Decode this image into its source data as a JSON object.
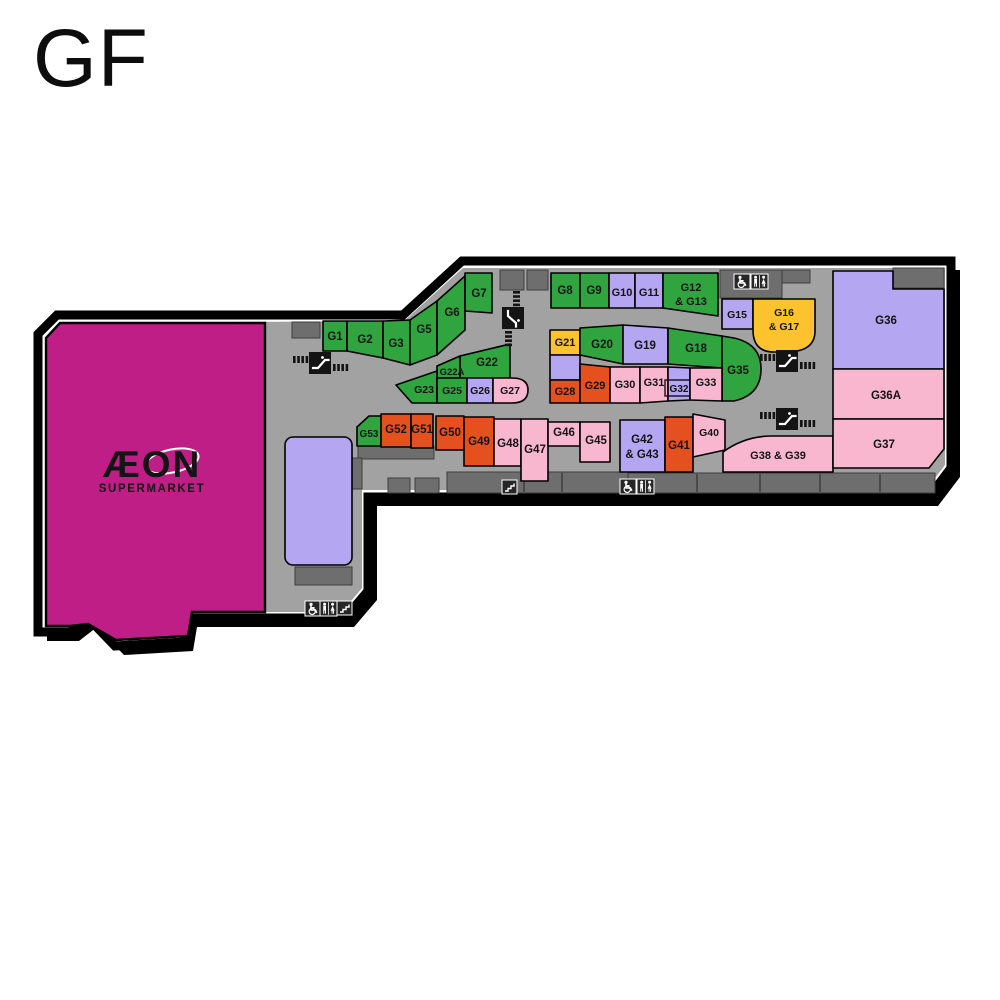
{
  "title": "GF",
  "supermarket": {
    "name": "ÆON",
    "subtitle": "SUPERMARKET"
  },
  "palette": {
    "green": "#2FA43F",
    "lavender": "#B4A6F0",
    "yellow": "#FDC32F",
    "orange": "#E4511E",
    "pink": "#F9B6CF",
    "magenta": "#BE1E86",
    "walkway": "#A2A2A2",
    "service": "#6E6E6E",
    "iconBox": "#262626",
    "outline": "#000000"
  },
  "outline": {
    "outer": "M38,334 L57,315 L403,315 L462,261 L951,261 L951,468 L929,497 L368,497 L368,591 L345,618 L188,618 L184,642 L115,646 L88,618 L70,632 L38,632 Z",
    "inner": "M46,338 L60,323 L404,321 L463,268 L945,268 L945,465 L926,490 L362,490 L362,588 L342,612 L192,612 L188,636 L116,640 L88,624 L71,626 L46,626 Z",
    "aeon": "M60,323 L265,323 L265,612 L192,612 L188,636 L116,640 L88,624 L71,626 L46,626 L46,338 Z"
  },
  "units": [
    {
      "id": "G1",
      "label": "G1",
      "color": "green",
      "poly": [
        [
          323,
          321
        ],
        [
          347,
          321
        ],
        [
          347,
          351
        ],
        [
          323,
          351
        ]
      ],
      "lx": 335,
      "ly": 340
    },
    {
      "id": "G2",
      "label": "G2",
      "color": "green",
      "poly": [
        [
          347,
          321
        ],
        [
          383,
          321
        ],
        [
          383,
          358
        ],
        [
          347,
          351
        ]
      ],
      "lx": 365,
      "ly": 343
    },
    {
      "id": "G3",
      "label": "G3",
      "color": "green",
      "poly": [
        [
          383,
          321
        ],
        [
          410,
          320
        ],
        [
          410,
          365
        ],
        [
          383,
          358
        ]
      ],
      "lx": 396,
      "ly": 347
    },
    {
      "id": "G5",
      "label": "G5",
      "color": "green",
      "poly": [
        [
          410,
          320
        ],
        [
          437,
          301
        ],
        [
          437,
          355
        ],
        [
          410,
          365
        ]
      ],
      "lx": 424,
      "ly": 333
    },
    {
      "id": "G6",
      "label": "G6",
      "color": "green",
      "poly": [
        [
          437,
          301
        ],
        [
          465,
          276
        ],
        [
          465,
          330
        ],
        [
          437,
          355
        ]
      ],
      "lx": 452,
      "ly": 316
    },
    {
      "id": "G7",
      "label": "G7",
      "color": "green",
      "poly": [
        [
          465,
          273
        ],
        [
          492,
          273
        ],
        [
          492,
          313
        ],
        [
          465,
          311
        ]
      ],
      "lx": 479,
      "ly": 297
    },
    {
      "id": "G8",
      "label": "G8",
      "color": "green",
      "poly": [
        [
          551,
          273
        ],
        [
          580,
          273
        ],
        [
          580,
          308
        ],
        [
          551,
          308
        ]
      ],
      "lx": 565,
      "ly": 294
    },
    {
      "id": "G9",
      "label": "G9",
      "color": "green",
      "poly": [
        [
          580,
          273
        ],
        [
          609,
          273
        ],
        [
          609,
          308
        ],
        [
          580,
          308
        ]
      ],
      "lx": 594,
      "ly": 294
    },
    {
      "id": "G10",
      "label": "G10",
      "color": "lavender",
      "poly": [
        [
          609,
          273
        ],
        [
          635,
          273
        ],
        [
          635,
          308
        ],
        [
          609,
          308
        ]
      ],
      "lx": 622,
      "ly": 296,
      "fs": 11
    },
    {
      "id": "G11",
      "label": "G11",
      "color": "lavender",
      "poly": [
        [
          635,
          273
        ],
        [
          663,
          273
        ],
        [
          663,
          308
        ],
        [
          635,
          308
        ]
      ],
      "lx": 649,
      "ly": 296,
      "fs": 11
    },
    {
      "id": "G12-G13",
      "lines": [
        "G12",
        "& G13"
      ],
      "color": "green",
      "poly": [
        [
          663,
          273
        ],
        [
          718,
          273
        ],
        [
          718,
          316
        ],
        [
          663,
          308
        ]
      ],
      "lx": 691,
      "ly": 291,
      "fs": 11,
      "lh": 14
    },
    {
      "id": "G15",
      "label": "G15",
      "color": "lavender",
      "poly": [
        [
          722,
          299
        ],
        [
          753,
          299
        ],
        [
          753,
          329
        ],
        [
          722,
          329
        ]
      ],
      "lx": 737,
      "ly": 318,
      "fs": 10.5
    },
    {
      "id": "G16-G17",
      "lines": [
        "G16",
        "& G17"
      ],
      "color": "yellow",
      "path": "M753,299 L815,299 L815,331 Q815,352 786,352 L774,352 Q753,352 753,330 Z",
      "lx": 784,
      "ly": 316,
      "fs": 10.5,
      "lh": 14
    },
    {
      "id": "G21",
      "label": "G21",
      "color": "yellow",
      "poly": [
        [
          550,
          330
        ],
        [
          580,
          330
        ],
        [
          580,
          355
        ],
        [
          550,
          355
        ]
      ],
      "lx": 565,
      "ly": 346,
      "fs": 11
    },
    {
      "id": "kiosk-a",
      "label": "",
      "color": "lavender",
      "poly": [
        [
          550,
          355
        ],
        [
          580,
          355
        ],
        [
          580,
          380
        ],
        [
          550,
          380
        ]
      ]
    },
    {
      "id": "G28",
      "label": "G28",
      "color": "orange",
      "poly": [
        [
          550,
          380
        ],
        [
          580,
          380
        ],
        [
          580,
          403
        ],
        [
          550,
          403
        ]
      ],
      "lx": 565,
      "ly": 395,
      "fs": 11
    },
    {
      "id": "G20",
      "label": "G20",
      "color": "green",
      "poly": [
        [
          580,
          328
        ],
        [
          623,
          325
        ],
        [
          623,
          364
        ],
        [
          580,
          355
        ]
      ],
      "lx": 602,
      "ly": 348
    },
    {
      "id": "G19",
      "label": "G19",
      "color": "lavender",
      "poly": [
        [
          623,
          325
        ],
        [
          668,
          328
        ],
        [
          668,
          364
        ],
        [
          623,
          364
        ]
      ],
      "lx": 645,
      "ly": 349
    },
    {
      "id": "G18",
      "label": "G18",
      "color": "green",
      "poly": [
        [
          668,
          328
        ],
        [
          722,
          336
        ],
        [
          722,
          368
        ],
        [
          668,
          364
        ]
      ],
      "lx": 696,
      "ly": 352
    },
    {
      "id": "G35",
      "label": "G35",
      "color": "green",
      "path": "M722,336 L734,338 Q761,344 761,369 Q761,395 734,401 L722,401 Z",
      "lx": 738,
      "ly": 374
    },
    {
      "id": "G29",
      "label": "G29",
      "color": "orange",
      "poly": [
        [
          580,
          364
        ],
        [
          610,
          367
        ],
        [
          610,
          403
        ],
        [
          580,
          403
        ]
      ],
      "lx": 595,
      "ly": 389,
      "fs": 11
    },
    {
      "id": "G30",
      "label": "G30",
      "color": "pink",
      "poly": [
        [
          610,
          367
        ],
        [
          640,
          367
        ],
        [
          640,
          403
        ],
        [
          610,
          403
        ]
      ],
      "lx": 625,
      "ly": 388,
      "fs": 11
    },
    {
      "id": "G31",
      "label": "G31",
      "color": "pink",
      "poly": [
        [
          640,
          367
        ],
        [
          668,
          367
        ],
        [
          668,
          401
        ],
        [
          640,
          403
        ]
      ],
      "lx": 654,
      "ly": 386,
      "fs": 11
    },
    {
      "id": "G32",
      "label": "G32",
      "color": "lavender",
      "poly": [
        [
          668,
          367
        ],
        [
          690,
          368
        ],
        [
          690,
          400
        ],
        [
          668,
          401
        ]
      ],
      "lx": 679,
      "ly": 392,
      "fs": 10,
      "boxed": true
    },
    {
      "id": "G33",
      "label": "G33",
      "color": "pink",
      "poly": [
        [
          690,
          368
        ],
        [
          722,
          368
        ],
        [
          722,
          401
        ],
        [
          690,
          400
        ]
      ],
      "lx": 706,
      "ly": 386,
      "fs": 11
    },
    {
      "id": "G22",
      "label": "G22",
      "color": "green",
      "poly": [
        [
          460,
          356
        ],
        [
          510,
          344
        ],
        [
          510,
          378
        ],
        [
          460,
          380
        ]
      ],
      "lx": 487,
      "ly": 366
    },
    {
      "id": "G22A",
      "label": "G22A",
      "color": "green",
      "poly": [
        [
          437,
          366
        ],
        [
          460,
          356
        ],
        [
          460,
          378
        ],
        [
          437,
          378
        ]
      ],
      "lx": 452,
      "ly": 375,
      "fs": 9.5
    },
    {
      "id": "G23",
      "label": "G23",
      "color": "green",
      "poly": [
        [
          396,
          385
        ],
        [
          437,
          371
        ],
        [
          437,
          403
        ],
        [
          412,
          403
        ]
      ],
      "lx": 424,
      "ly": 393,
      "fs": 10.5
    },
    {
      "id": "G25",
      "label": "G25",
      "color": "green",
      "poly": [
        [
          437,
          378
        ],
        [
          467,
          378
        ],
        [
          467,
          403
        ],
        [
          437,
          403
        ]
      ],
      "lx": 452,
      "ly": 394,
      "fs": 10.5
    },
    {
      "id": "G26",
      "label": "G26",
      "color": "lavender",
      "poly": [
        [
          467,
          378
        ],
        [
          493,
          378
        ],
        [
          493,
          403
        ],
        [
          467,
          403
        ]
      ],
      "lx": 480,
      "ly": 394,
      "fs": 10.5
    },
    {
      "id": "G27",
      "label": "G27",
      "color": "pink",
      "path": "M493,378 L512,378 Q528,378 528,390 Q528,403 512,403 L493,403 Z",
      "lx": 510,
      "ly": 394,
      "fs": 10.5
    },
    {
      "id": "G53",
      "label": "G53",
      "color": "green",
      "poly": [
        [
          357,
          427
        ],
        [
          369,
          416
        ],
        [
          381,
          416
        ],
        [
          381,
          446
        ],
        [
          357,
          446
        ]
      ],
      "lx": 369,
      "ly": 437,
      "fs": 10
    },
    {
      "id": "G52",
      "label": "G52",
      "color": "orange",
      "poly": [
        [
          381,
          414
        ],
        [
          411,
          414
        ],
        [
          411,
          447
        ],
        [
          381,
          447
        ]
      ],
      "lx": 396,
      "ly": 433
    },
    {
      "id": "G51",
      "label": "G51",
      "color": "orange",
      "poly": [
        [
          411,
          414
        ],
        [
          433,
          414
        ],
        [
          433,
          448
        ],
        [
          411,
          448
        ]
      ],
      "lx": 422,
      "ly": 433
    },
    {
      "id": "G50",
      "label": "G50",
      "color": "orange",
      "poly": [
        [
          436,
          416
        ],
        [
          464,
          416
        ],
        [
          464,
          450
        ],
        [
          436,
          450
        ]
      ],
      "lx": 450,
      "ly": 436
    },
    {
      "id": "G49",
      "label": "G49",
      "color": "orange",
      "poly": [
        [
          464,
          417
        ],
        [
          494,
          417
        ],
        [
          494,
          466
        ],
        [
          464,
          466
        ]
      ],
      "lx": 479,
      "ly": 445
    },
    {
      "id": "G48",
      "label": "G48",
      "color": "pink",
      "poly": [
        [
          494,
          419
        ],
        [
          521,
          419
        ],
        [
          521,
          466
        ],
        [
          494,
          466
        ]
      ],
      "lx": 508,
      "ly": 447
    },
    {
      "id": "G47",
      "label": "G47",
      "color": "pink",
      "poly": [
        [
          521,
          419
        ],
        [
          548,
          419
        ],
        [
          548,
          481
        ],
        [
          521,
          481
        ]
      ],
      "lx": 535,
      "ly": 453
    },
    {
      "id": "G46",
      "label": "G46",
      "color": "pink",
      "poly": [
        [
          548,
          422
        ],
        [
          580,
          422
        ],
        [
          580,
          446
        ],
        [
          548,
          446
        ]
      ],
      "lx": 564,
      "ly": 436
    },
    {
      "id": "G45",
      "label": "G45",
      "color": "pink",
      "poly": [
        [
          580,
          422
        ],
        [
          610,
          422
        ],
        [
          610,
          462
        ],
        [
          580,
          462
        ]
      ],
      "lx": 596,
      "ly": 444
    },
    {
      "id": "G42-G43",
      "lines": [
        "G42",
        "& G43"
      ],
      "color": "lavender",
      "poly": [
        [
          620,
          420
        ],
        [
          665,
          420
        ],
        [
          665,
          472
        ],
        [
          620,
          472
        ]
      ],
      "lx": 642,
      "ly": 443,
      "lh": 15
    },
    {
      "id": "G41",
      "label": "G41",
      "color": "orange",
      "poly": [
        [
          665,
          417
        ],
        [
          693,
          417
        ],
        [
          693,
          472
        ],
        [
          665,
          472
        ]
      ],
      "lx": 679,
      "ly": 449
    },
    {
      "id": "G40",
      "label": "G40",
      "color": "pink",
      "poly": [
        [
          693,
          414
        ],
        [
          725,
          420
        ],
        [
          725,
          450
        ],
        [
          693,
          457
        ]
      ],
      "lx": 709,
      "ly": 436,
      "fs": 10.5
    },
    {
      "id": "G38-G39",
      "label": "G38 & G39",
      "color": "pink",
      "path": "M723,452 Q745,436 772,436 L833,436 L833,472 L723,472 Z",
      "lx": 778,
      "ly": 459,
      "fs": 11
    },
    {
      "id": "G36",
      "label": "G36",
      "color": "lavender",
      "path": "M833,271 L893,271 L893,289 L944,289 L944,369 L833,369 Z",
      "lx": 886,
      "ly": 324
    },
    {
      "id": "G36A",
      "label": "G36A",
      "color": "pink",
      "poly": [
        [
          833,
          369
        ],
        [
          944,
          369
        ],
        [
          944,
          419
        ],
        [
          833,
          419
        ]
      ],
      "lx": 886,
      "ly": 399
    },
    {
      "id": "G37",
      "label": "G37",
      "color": "pink",
      "path": "M833,419 L944,419 L944,449 L929,468 L833,468 Z",
      "lx": 884,
      "ly": 448
    },
    {
      "id": "kiosk-b",
      "label": "",
      "color": "lavender",
      "rect": [
        285,
        437,
        67,
        128,
        8
      ]
    }
  ],
  "services": [
    [
      292,
      322,
      28,
      16
    ],
    [
      500,
      270,
      24,
      20
    ],
    [
      527,
      270,
      21,
      20
    ],
    [
      720,
      270,
      62,
      28
    ],
    [
      782,
      270,
      28,
      13
    ],
    [
      893,
      268,
      51,
      20
    ],
    [
      358,
      433,
      23,
      26
    ],
    [
      358,
      446,
      76,
      13
    ],
    [
      348,
      458,
      14,
      31
    ],
    [
      388,
      478,
      22,
      15
    ],
    [
      415,
      478,
      24,
      15
    ],
    [
      447,
      472,
      181,
      21
    ],
    [
      628,
      473,
      307,
      20
    ],
    [
      295,
      567,
      57,
      18
    ]
  ],
  "dividers": [
    [
      524,
      473,
      492
    ],
    [
      562,
      473,
      492
    ],
    [
      697,
      474,
      492
    ],
    [
      760,
      474,
      492
    ],
    [
      820,
      474,
      492
    ],
    [
      880,
      474,
      492
    ]
  ],
  "icons": [
    {
      "type": "escalator",
      "x": 293,
      "y": 352
    },
    {
      "type": "escalator",
      "x": 513,
      "y": 317,
      "vertical": true
    },
    {
      "type": "escalator",
      "x": 760,
      "y": 350
    },
    {
      "type": "escalator",
      "x": 760,
      "y": 408
    },
    {
      "type": "stairs",
      "x": 502,
      "y": 480
    },
    {
      "type": "accessible",
      "x": 620,
      "y": 479
    },
    {
      "type": "wc",
      "x": 637,
      "y": 479
    },
    {
      "type": "accessible",
      "x": 734,
      "y": 274
    },
    {
      "type": "wc",
      "x": 751,
      "y": 274
    },
    {
      "type": "accessible",
      "x": 305,
      "y": 601
    },
    {
      "type": "wc",
      "x": 320,
      "y": 601
    },
    {
      "type": "stairs",
      "x": 337,
      "y": 601
    }
  ],
  "aeon_label": {
    "x": 152,
    "y": 477,
    "sub_y": 492
  }
}
